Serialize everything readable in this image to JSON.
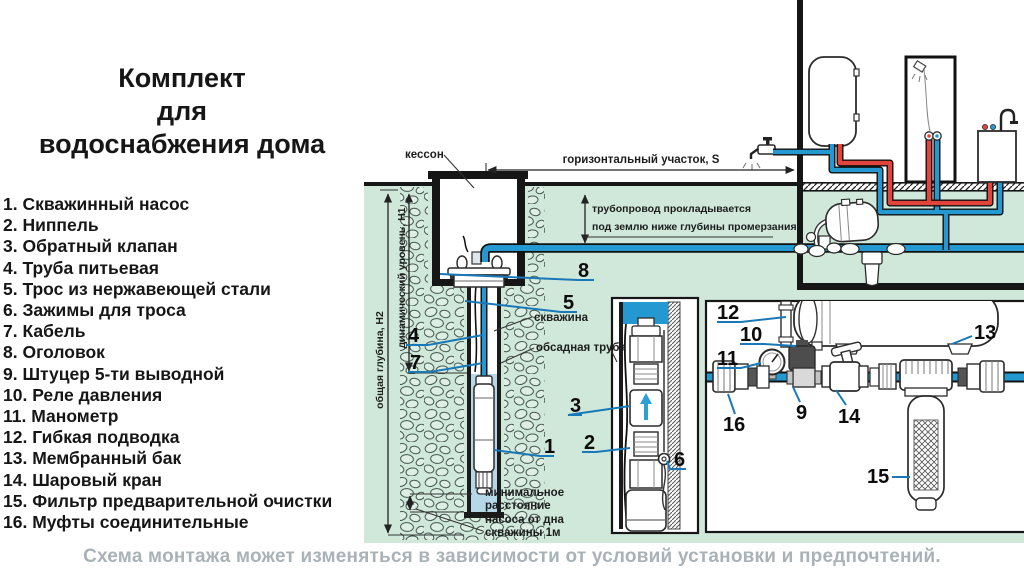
{
  "title": {
    "line1": "Комплект",
    "line2": "для",
    "line3": "водоснабжения дома"
  },
  "parts_list": {
    "items": [
      "1. Скважинный насос",
      "2. Ниппель",
      "3. Обратный клапан",
      "4. Труба питьевая",
      "5. Трос из нержавеющей стали",
      "6. Зажимы для троса",
      "7. Кабель",
      "8. Оголовок",
      "9. Штуцер 5-ти выводной",
      "10. Реле давления",
      "11. Манометр",
      "12. Гибкая подводка",
      "13. Мембранный бак",
      "14. Шаровый кран",
      "15. Фильтр предварительной очистки",
      "16. Муфты соединительные"
    ]
  },
  "diagram": {
    "labels": {
      "kesson": "кессон",
      "horizontal_section": "горизонтальный участок,  S",
      "pipeline_note_line1": "трубопровод прокладывается",
      "pipeline_note_line2": "под землю ниже глубины промерзания",
      "well": "скважина",
      "casing": "обсадная труба",
      "total_depth": "общая глубина, Н2",
      "dynamic_level": "динамический уровень, Н1",
      "min_distance_l1": "минимальное",
      "min_distance_l2": "расстояние",
      "min_distance_l3": "насоса от дна",
      "min_distance_l4": "скважины 1м"
    },
    "callouts": [
      "1",
      "2",
      "3",
      "4",
      "5",
      "6",
      "7",
      "8",
      "9",
      "10",
      "11",
      "12",
      "13",
      "14",
      "15",
      "16"
    ],
    "colors": {
      "ground_green": "#cfe8da",
      "pipe_blue": "#2499d1",
      "pipe_red": "#e2443b",
      "well_water": "#b6d7e8",
      "leader_blue": "#1878b8"
    }
  },
  "footer": {
    "note": "Схема монтажа может изменяться в зависимости от условий установки и предпочтений."
  }
}
